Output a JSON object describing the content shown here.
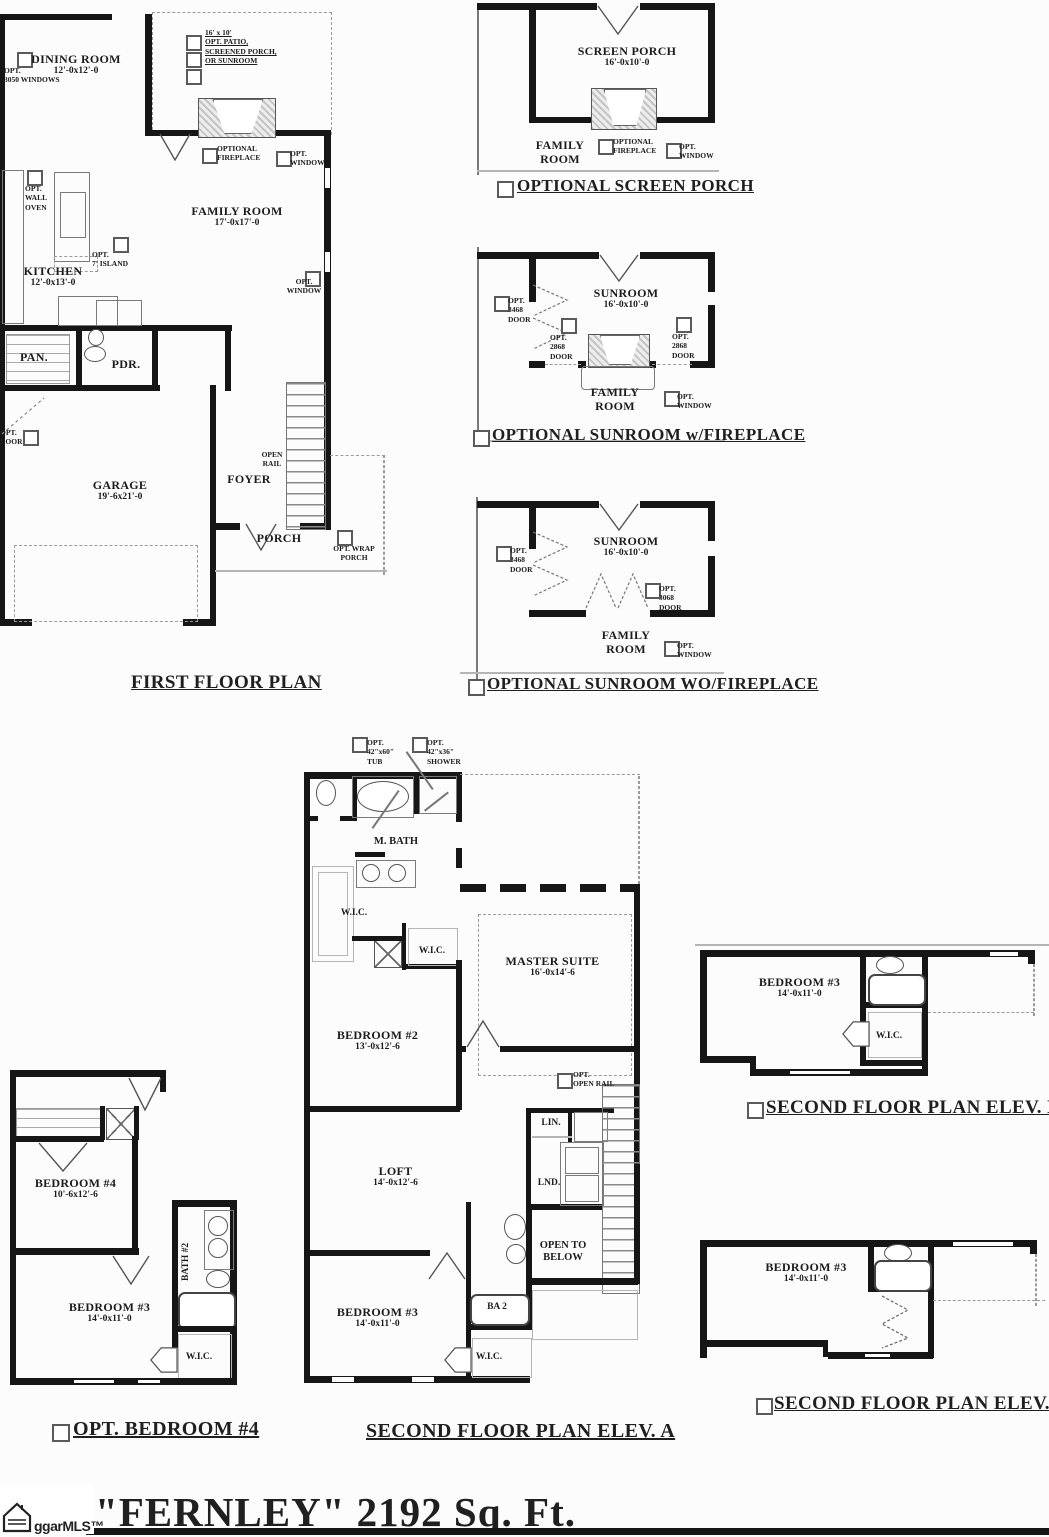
{
  "colors": {
    "wall": "#161616",
    "thin_line": "#7a7a7a",
    "dash": "#9a9a9a",
    "text": "#1c1c1c",
    "background": "#fcfcfc"
  },
  "first_floor": {
    "caption": "FIRST FLOOR PLAN",
    "dining": "DINING ROOM\n12'-0x12'-0",
    "opt_windows": "OPT.\n3050 WINDOWS",
    "patio_note": "16' x 10'\nOPT. PATIO,\nSCREENED PORCH,\nOR SUNROOM",
    "family": "FAMILY ROOM\n17'-0x17'-0",
    "optional_fireplace": "OPTIONAL\nFIREPLACE",
    "opt_window": "OPT.\nWINDOW",
    "opt_wall_oven": "OPT.\nWALL\nOVEN",
    "opt_island": "OPT.\n7' ISLAND",
    "kitchen": "KITCHEN\n12'-0x13'-0",
    "pantry": "PAN.",
    "powder": "PDR.",
    "opt_door": "OPT.\nDOOR",
    "garage": "GARAGE\n19'-6x21'-0",
    "open_rail": "OPEN\nRAIL",
    "foyer": "FOYER",
    "porch": "PORCH",
    "opt_wrap_porch": "OPT. WRAP\nPORCH"
  },
  "screen_porch": {
    "caption": "OPTIONAL SCREEN PORCH",
    "room": "SCREEN PORCH\n16'-0x10'-0",
    "optional_fireplace": "OPTIONAL\nFIREPLACE",
    "opt_window": "OPT.\nWINDOW",
    "family_room": "FAMILY\nROOM"
  },
  "sunroom_fp": {
    "caption": "OPTIONAL SUNROOM w/FIREPLACE",
    "room": "SUNROOM\n16'-0x10'-0",
    "opt_3468_door": "OPT.\n3468\nDOOR",
    "opt_2868_door": "OPT.\n2868\nDOOR",
    "family_room": "FAMILY\nROOM",
    "opt_window": "OPT.\nWINDOW"
  },
  "sunroom_nofp": {
    "caption": "OPTIONAL SUNROOM WO/FIREPLACE",
    "room": "SUNROOM\n16'-0x10'-0",
    "opt_3468_door": "OPT.\n3468\nDOOR",
    "opt_3068_door": "OPT.\n3068\nDOOR",
    "family_room": "FAMILY\nROOM",
    "opt_window": "OPT.\nWINDOW"
  },
  "second_a": {
    "caption": "SECOND FLOOR PLAN ELEV. A",
    "opt_tub": "OPT.\n42\"x60\"\nTUB",
    "opt_shower": "OPT.\n42\"x36\"\nSHOWER",
    "m_bath": "M. BATH",
    "wic": "W.I.C.",
    "master": "MASTER SUITE\n16'-0x14'-6",
    "bedroom2": "BEDROOM #2\n13'-0x12'-6",
    "opt_open_rail": "OPT.\nOPEN RAIL",
    "linen": "LIN.",
    "laundry": "LND.",
    "loft": "LOFT\n14'-0x12'-6",
    "open_below": "OPEN TO\nBELOW",
    "bedroom3": "BEDROOM #3\n14'-0x11'-0",
    "bath2": "BA 2"
  },
  "second_b": {
    "caption": "SECOND FLOOR PLAN ELEV. B",
    "bedroom3": "BEDROOM #3\n14'-0x11'-0",
    "wic": "W.I.C."
  },
  "second_c": {
    "caption": "SECOND FLOOR PLAN ELEV. C",
    "bedroom3": "BEDROOM #3\n14'-0x11'-0"
  },
  "opt_bedroom4": {
    "caption": "OPT. BEDROOM #4",
    "bedroom4": "BEDROOM #4\n10'-6x12'-6",
    "bath2": "BATH #2",
    "bedroom3": "BEDROOM #3\n14'-0x11'-0",
    "wic": "W.I.C."
  },
  "footer": {
    "plan_title": "\"FERNLEY\" 2192 Sq. Ft.",
    "watermark": "ggarMLS™"
  }
}
